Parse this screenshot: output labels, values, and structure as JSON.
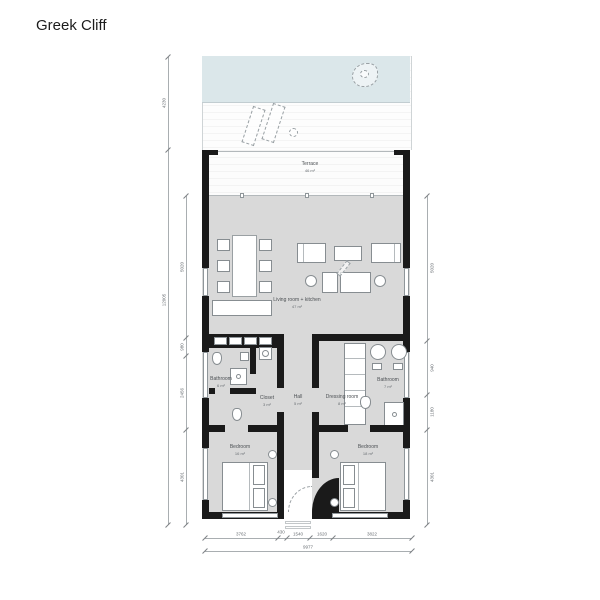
{
  "title": "Greek Cliff",
  "colors": {
    "pool": "#dbe7ea",
    "floor_gray": "#d9d9d9",
    "wall": "#1a1a1a"
  },
  "rooms": {
    "terrace": {
      "label": "Terrace",
      "area": "46 m²"
    },
    "living": {
      "label": "Living room + kitchen",
      "area": "47 m²"
    },
    "bathroom_left": {
      "label": "Bathroom",
      "area": "6 m²"
    },
    "closet": {
      "label": "Closet",
      "area": "3 m²"
    },
    "hall": {
      "label": "Hall",
      "area": "5 m²"
    },
    "dressing": {
      "label": "Dressing room",
      "area": "8 m²"
    },
    "bathroom_right": {
      "label": "Bathroom",
      "area": "7 m²"
    },
    "bedroom_left": {
      "label": "Bedroom",
      "area": "16 m²"
    },
    "bedroom_right": {
      "label": "Bedroom",
      "area": "18 m²"
    }
  },
  "dimensions": {
    "left_outer": [
      "4230",
      "12005"
    ],
    "left_inner": [
      "5020",
      "980",
      "2456",
      "4301"
    ],
    "right_side": [
      "5020",
      "940",
      "1180",
      "4301"
    ],
    "bottom": [
      "3762",
      "430",
      "1540",
      "1620",
      "3822"
    ],
    "bottom_total": "9977"
  }
}
